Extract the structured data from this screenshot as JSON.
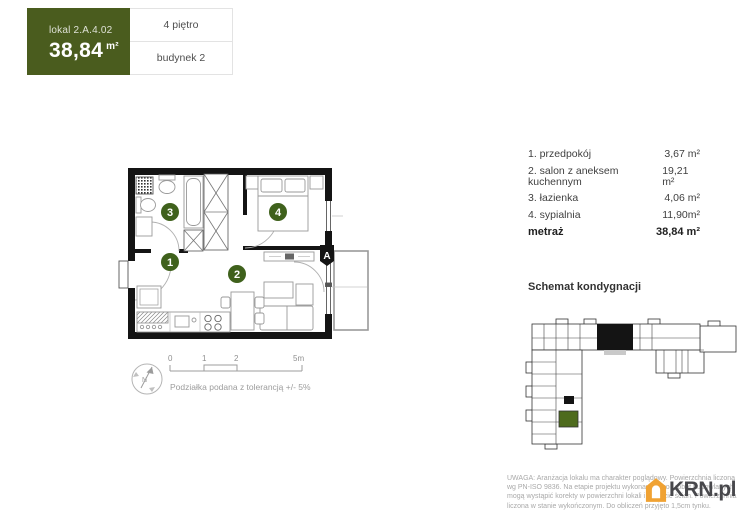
{
  "header": {
    "unit_label": "lokal 2.A.4.02",
    "area_value": "38,84",
    "area_unit": "m²",
    "floor": "4 piętro",
    "building": "budynek 2"
  },
  "room_list": {
    "rows": [
      {
        "label": "1. przedpokój",
        "area": "3,67 m²"
      },
      {
        "label": "2. salon z aneksem kuchennym",
        "area": "19,21 m²"
      },
      {
        "label": "3. łazienka",
        "area": "4,06 m²"
      },
      {
        "label": "4. sypialnia",
        "area": "11,90m²"
      }
    ],
    "total_label": "metraż",
    "total_area": "38,84 m²"
  },
  "plan": {
    "numbers": [
      "1",
      "2",
      "3",
      "4"
    ],
    "balcony_marker": "A",
    "compass_label": "N",
    "scale_ticks": [
      "0",
      "1",
      "2",
      "5m"
    ],
    "scale_note": "Podziałka podana z tolerancją +/- 5%"
  },
  "schematic": {
    "title": "Schemat kondygnacji"
  },
  "footer": {
    "lines": [
      "UWAGA: Aranżacja lokalu ma charakter poglądowy. Powierzchnia liczona",
      "wg PN-ISO 9836. Na etapie projektu wykonawczego i robót budowlanych",
      "mogą wystąpić korekty w powierzchni lokali i układzie ścian. Powierzchnia",
      "liczona w stanie wykończonym. Do obliczeń przyjęto 1,5cm tynku."
    ],
    "logo_text": "KRN.pl"
  },
  "colors": {
    "brand_green": "#4a5c1e",
    "marker_green": "#3f611c",
    "logo_orange": "#f0a233"
  }
}
